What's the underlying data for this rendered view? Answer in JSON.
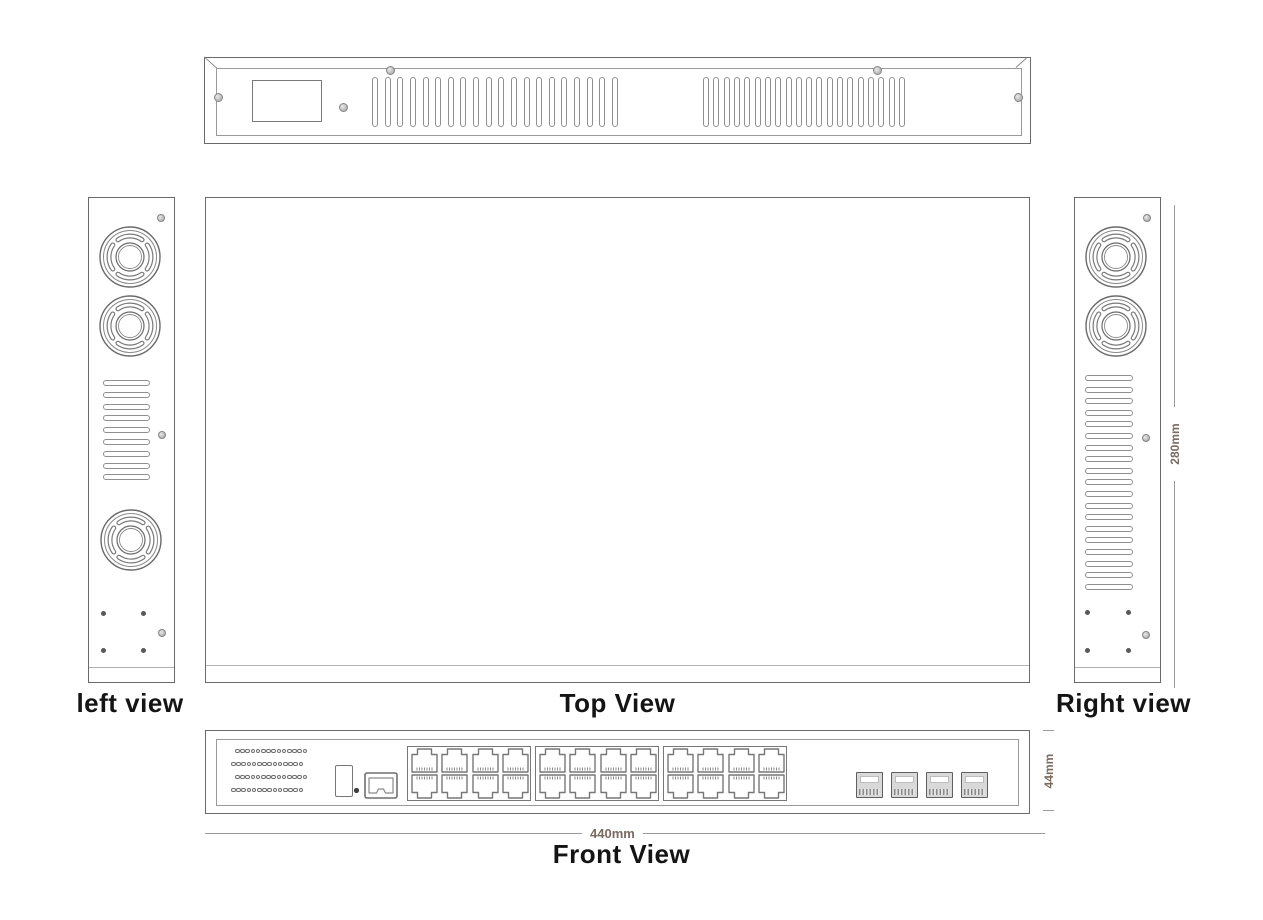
{
  "views": {
    "rear_top_strip": {
      "vent_groups": 2,
      "vent_slots_per_group": 20,
      "screws": 5,
      "has_label_plate": true
    },
    "left": {
      "label": "left view",
      "fans": 3,
      "vent_slots": 9,
      "mount_holes": 4,
      "screws": 3
    },
    "top": {
      "label": "Top View"
    },
    "right": {
      "label": "Right view",
      "fans": 2,
      "vent_slots": 19,
      "mount_holes": 4,
      "screws": 3
    },
    "front": {
      "label": "Front View",
      "led_rows": 4,
      "leds_per_row": 14,
      "rj45_port_groups": 3,
      "rj45_ports_per_group": 8,
      "rj45_ports_total": 24,
      "sfp_ports": 4,
      "console_ports": 1
    }
  },
  "dimensions": {
    "width": "440mm",
    "height": "44mm",
    "depth": "280mm"
  },
  "colors": {
    "outline": "#6a6a6a",
    "outline_light": "#9a9a9a",
    "detail": "#8a8a8a",
    "dimension_text": "#7b6a60",
    "label_text": "#141414",
    "background": "#ffffff"
  }
}
